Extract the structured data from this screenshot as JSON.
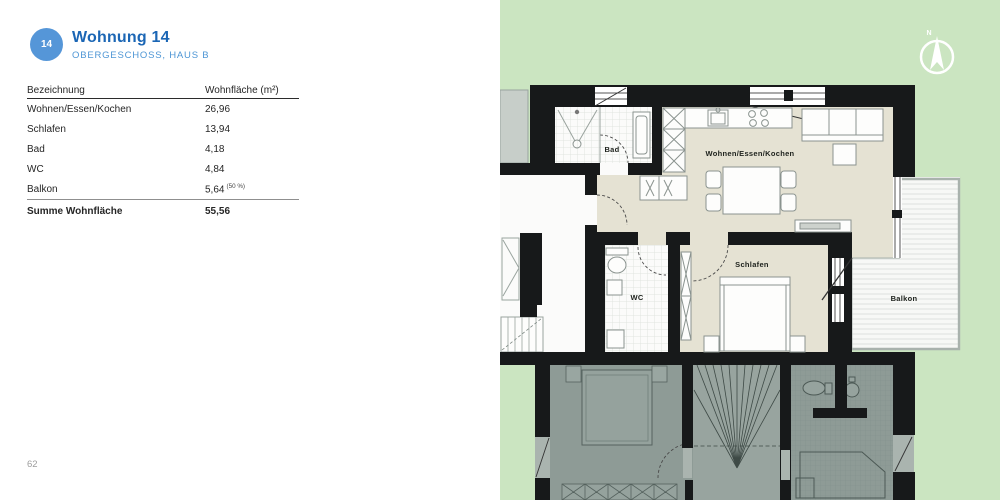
{
  "page": {
    "number": "62"
  },
  "header": {
    "badge": "14",
    "title": "Wohnung 14",
    "subtitle": "OBERGESCHOSS, HAUS B"
  },
  "table": {
    "columns": {
      "col1": "Bezeichnung",
      "col2": "Wohnfläche (m²)"
    },
    "rows": [
      {
        "label": "Wohnen/Essen/Kochen",
        "value": "26,96"
      },
      {
        "label": "Schlafen",
        "value": "13,94"
      },
      {
        "label": "Bad",
        "value": "4,18"
      },
      {
        "label": "WC",
        "value": "4,84"
      },
      {
        "label": "Balkon",
        "value": "5,64",
        "note": "(50 %)"
      }
    ],
    "total": {
      "label": "Summe Wohnfläche",
      "value": "55,56"
    }
  },
  "floorplan": {
    "rooms": {
      "bad": "Bad",
      "wohnen": "Wohnen/Essen/Kochen",
      "schlafen": "Schlafen",
      "wc": "WC",
      "balkon": "Balkon"
    },
    "compass": "N",
    "colors": {
      "background_green": "#cbe5c1",
      "highlight_beige": "#e5e2d3",
      "wall_black": "#17191a",
      "neighbor_gray": "#8e9b96",
      "accent_blue": "#1b66b5",
      "badge_blue": "#5596d8"
    }
  }
}
